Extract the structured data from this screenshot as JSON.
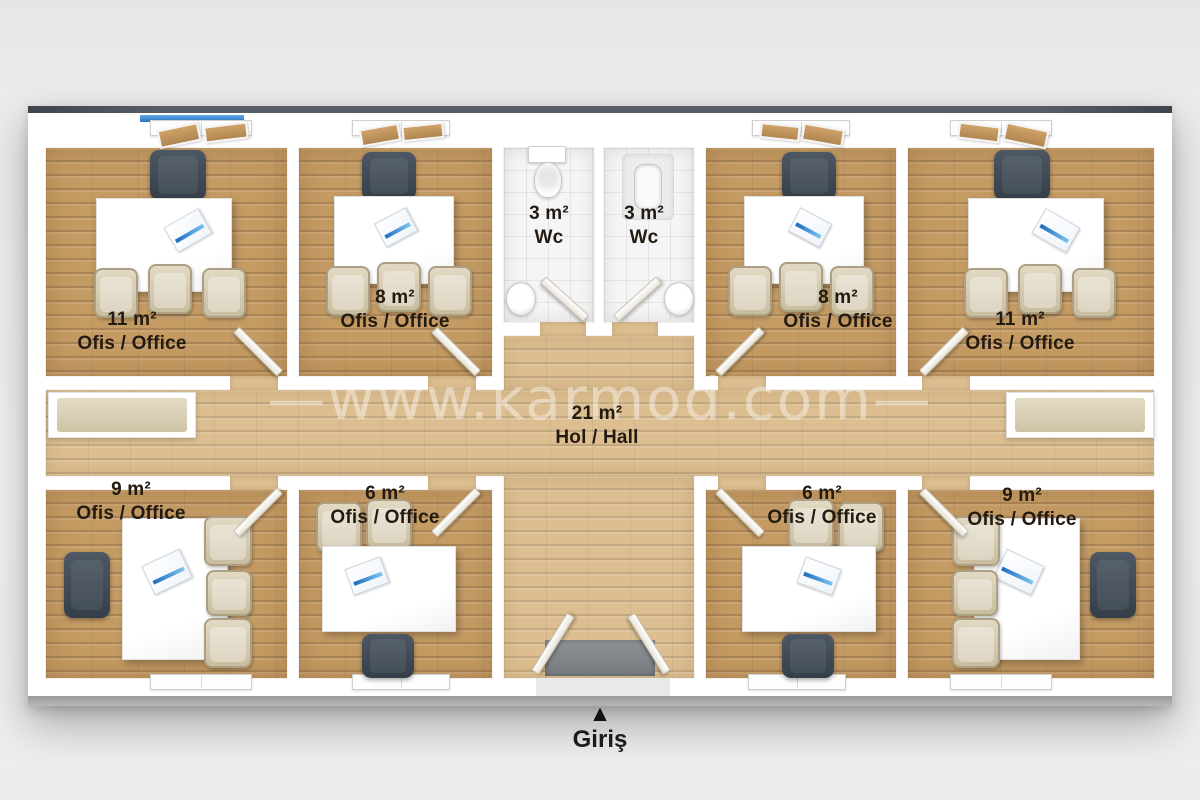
{
  "watermark": "—www.karmod.com—",
  "entrance": {
    "label": "Giriş",
    "arrow": "▲"
  },
  "rooms": {
    "office_11_top_left": {
      "area": "11 m²",
      "label": "Ofis / Office"
    },
    "office_8_top_left": {
      "area": "8 m²",
      "label": "Ofis / Office"
    },
    "wc_left": {
      "area": "3 m²",
      "label": "Wc"
    },
    "wc_right": {
      "area": "3 m²",
      "label": "Wc"
    },
    "office_8_top_right": {
      "area": "8 m²",
      "label": "Ofis / Office"
    },
    "office_11_top_right": {
      "area": "11 m²",
      "label": "Ofis / Office"
    },
    "hall": {
      "area": "21 m²",
      "label": "Hol / Hall"
    },
    "office_9_bottom_left": {
      "area": "9 m²",
      "label": "Ofis / Office"
    },
    "office_6_bottom_left": {
      "area": "6 m²",
      "label": "Ofis / Office"
    },
    "office_6_bottom_right": {
      "area": "6 m²",
      "label": "Ofis / Office"
    },
    "office_9_bottom_right": {
      "area": "9 m²",
      "label": "Ofis / Office"
    }
  },
  "colors": {
    "office_floor": "#c59b64",
    "hall_floor": "#dcbe90",
    "wc_tile": "#f5f5f5",
    "wall": "#ffffff",
    "roof_edge": "#585e66",
    "window_glass": "#3787d6",
    "label_text": "#231a11",
    "office_chair": "#46525c",
    "guest_chair": "#d8cdb4",
    "entrance_mat": "#878c90"
  }
}
